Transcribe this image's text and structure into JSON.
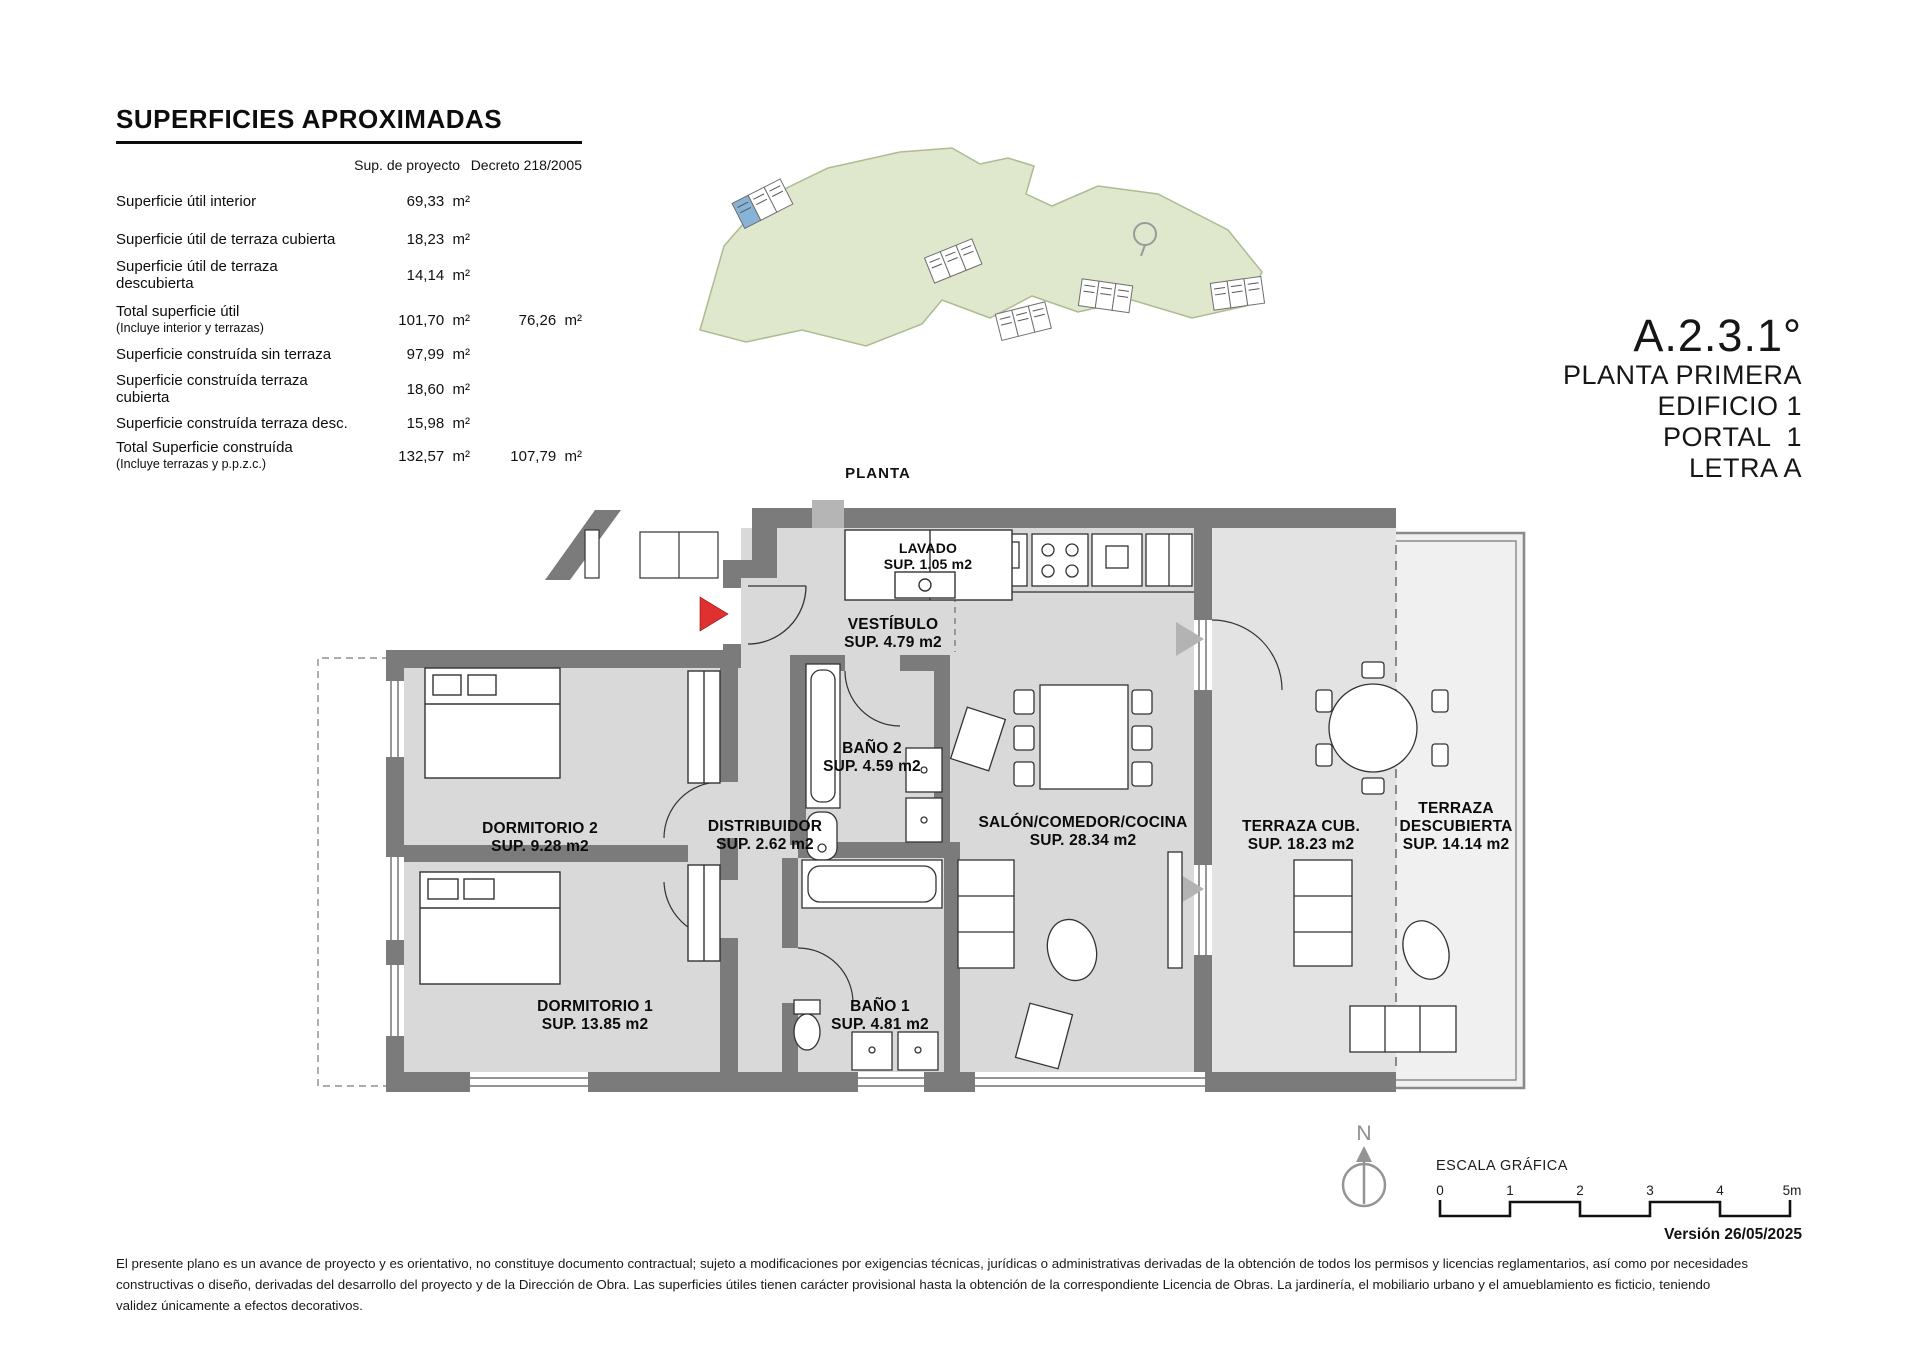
{
  "page": {
    "plan_heading": "PLANTA",
    "version": "Versión 26/05/2025",
    "north_letter": "N"
  },
  "surfaces_table": {
    "title": "SUPERFICIES APROXIMADAS",
    "columns": [
      "Sup. de proyecto",
      "Decreto 218/2005"
    ],
    "rows": [
      {
        "label": "Superficie útil interior",
        "sub": "",
        "project": "69,33  m²",
        "decreto": ""
      },
      {
        "label": "Superficie útil de terraza cubierta",
        "sub": "",
        "project": "18,23  m²",
        "decreto": ""
      },
      {
        "label": "Superficie útil de terraza descubierta",
        "sub": "",
        "project": "14,14  m²",
        "decreto": ""
      },
      {
        "label": "Total superficie útil",
        "sub": "(Incluye interior y terrazas)",
        "project": "101,70  m²",
        "decreto": "76,26  m²"
      },
      {
        "label": "Superficie construída sin terraza",
        "sub": "",
        "project": "97,99  m²",
        "decreto": ""
      },
      {
        "label": "Superficie construída terraza cubierta",
        "sub": "",
        "project": "18,60  m²",
        "decreto": ""
      },
      {
        "label": "Superficie construída terraza desc.",
        "sub": "",
        "project": "15,98  m²",
        "decreto": ""
      },
      {
        "label": "Total Superficie construída",
        "sub": "(Incluye terrazas y p.p.z.c.)",
        "project": "132,57  m²",
        "decreto": "107,79  m²"
      }
    ]
  },
  "title_block": {
    "code": "A.2.3.1°",
    "line1": "PLANTA PRIMERA",
    "line2": "EDIFICIO 1",
    "line3": "PORTAL  1",
    "line4": "LETRA A"
  },
  "rooms": {
    "lavado": {
      "name": "LAVADO",
      "sup": "SUP. 1.05 m2"
    },
    "vestibulo": {
      "name": "VESTÍBULO",
      "sup": "SUP. 4.79 m2"
    },
    "bano2": {
      "name": "BAÑO 2",
      "sup": "SUP. 4.59 m2"
    },
    "distribuidor": {
      "name": "DISTRIBUIDOR",
      "sup": "SUP. 2.62 m2"
    },
    "dormitorio2": {
      "name": "DORMITORIO 2",
      "sup": "SUP. 9.28 m2"
    },
    "dormitorio1": {
      "name": "DORMITORIO 1",
      "sup": "SUP. 13.85 m2"
    },
    "bano1": {
      "name": "BAÑO 1",
      "sup": "SUP. 4.81 m2"
    },
    "salon": {
      "name": "SALÓN/COMEDOR/COCINA",
      "sup": "SUP. 28.34 m2"
    },
    "terraza_cubierta": {
      "name": "TERRAZA CUB.",
      "sup": "SUP. 18.23 m2"
    },
    "terraza_descubierta": {
      "name1": "TERRAZA",
      "name2": "DESCUBIERTA",
      "sup": "SUP. 14.14 m2"
    }
  },
  "scale_bar": {
    "label": "ESCALA GRÁFICA",
    "ticks": [
      "0",
      "1",
      "2",
      "3",
      "4",
      "5m"
    ]
  },
  "disclaimer": {
    "line1": "El presente plano es un avance de proyecto y es orientativo, no constituye documento contractual; sujeto a modificaciones por exigencias técnicas, jurídicas o administrativas derivadas de la obtención de todos los permisos y licencias reglamentarios, así como por necesidades",
    "line2": "constructivas o diseño, derivadas del desarrollo del proyecto y de la Dirección de Obra. Las superficies útiles tienen carácter provisional hasta la obtención de la correspondiente Licencia de Obras. La jardinería, el mobiliario urbano y el amueblamiento es ficticio, teniendo",
    "line3": "validez únicamente a efectos decorativos."
  }
}
